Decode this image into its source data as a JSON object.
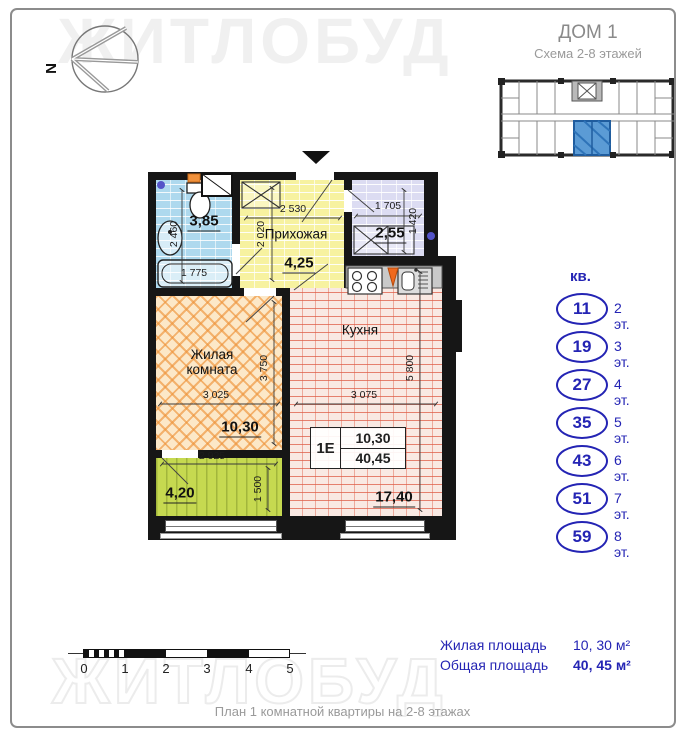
{
  "header": {
    "house_title": "ДОМ 1",
    "scheme_subtitle": "Схема 2-8 этажей"
  },
  "watermark": {
    "text": "ЖИТЛОБУД"
  },
  "compass": {
    "north_label": "N"
  },
  "apartment_list": {
    "header": "кв.",
    "items": [
      {
        "number": "11",
        "floor": "2 эт."
      },
      {
        "number": "19",
        "floor": "3 эт."
      },
      {
        "number": "27",
        "floor": "4 эт."
      },
      {
        "number": "35",
        "floor": "5 эт."
      },
      {
        "number": "43",
        "floor": "6 эт."
      },
      {
        "number": "51",
        "floor": "7 эт."
      },
      {
        "number": "59",
        "floor": "8 эт."
      }
    ]
  },
  "plan": {
    "bathroom": {
      "area": "3,85",
      "width": "1 775",
      "height": "2 460"
    },
    "hallway": {
      "name": "Прихожая",
      "area": "4,25",
      "width": "2 530",
      "height": "2 020"
    },
    "storage": {
      "area": "2,55",
      "width": "1 705",
      "height": "1 420"
    },
    "living": {
      "name": "Жилая комната",
      "area": "10,30",
      "width": "3 025",
      "height": "3 750"
    },
    "kitchen": {
      "name": "Кухня",
      "area": "17,40",
      "width": "3 075",
      "height": "5 800"
    },
    "balcony": {
      "area": "4,20",
      "width": "2 925",
      "height": "1 500"
    },
    "info_box": {
      "type": "1Е",
      "living_area": "10,30",
      "total_area": "40,45"
    }
  },
  "scale_bar": {
    "labels": [
      "0",
      "1",
      "2",
      "3",
      "4",
      "5"
    ]
  },
  "summary": {
    "rows": [
      {
        "label": "Жилая площадь",
        "value": "10, 30 м²"
      },
      {
        "label": "Общая площадь",
        "value": "40, 45 м²"
      }
    ]
  },
  "caption": "План 1 комнатной квартиры на 2-8 этажах",
  "colors": {
    "accent_blue": "#2424b4",
    "highlight_apartment": "#5b9bd5"
  }
}
